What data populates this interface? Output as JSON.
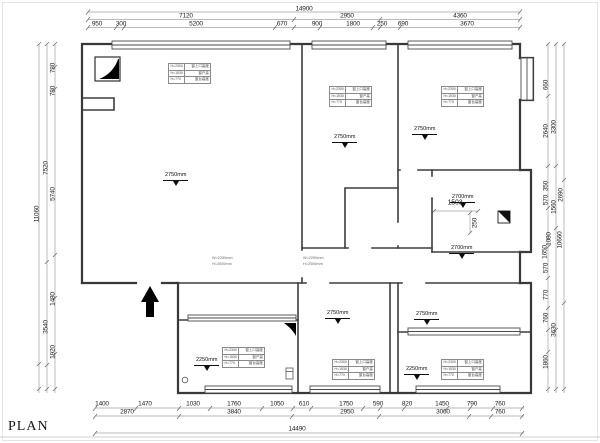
{
  "title": {
    "plan_label": "PLAN"
  },
  "dims": {
    "top1": [
      "14900"
    ],
    "top2": [
      "7120",
      "2950",
      "4360"
    ],
    "top3": [
      "950",
      "300",
      "5200",
      "670",
      "900",
      "1800",
      "250",
      "690",
      "3670"
    ],
    "bottom1": [
      "1400",
      "1470",
      "1030",
      "1760",
      "1050",
      "610",
      "1750",
      "590",
      "820",
      "1450",
      "790",
      "760"
    ],
    "bottom2": [
      "2870",
      "3840",
      "2950",
      "3060",
      "760"
    ],
    "bottom3": [
      "14490"
    ],
    "left": [
      "780",
      "780",
      "7520",
      "5740",
      "11060",
      "1480",
      "3540",
      "1920"
    ],
    "right": [
      "660",
      "3300",
      "2640",
      "2690",
      "350",
      "570",
      "1560",
      "1080",
      "1650",
      "10660",
      "570",
      "770",
      "760",
      "3630",
      "1860"
    ],
    "inner_w": "1503",
    "inner_h": "250"
  },
  "levels": {
    "l2750": "2750mm",
    "l2700": "2700mm",
    "l2250": "2250mm"
  },
  "room_table": {
    "rows": [
      {
        "code": "H=2300",
        "label": "窗上口高度"
      },
      {
        "code": "H=1530",
        "label": "窗户高"
      },
      {
        "code": "H=770",
        "label": "窗台高度"
      }
    ]
  },
  "notes": {
    "line1": "W=2250mm",
    "line2": "H=2000mm"
  }
}
